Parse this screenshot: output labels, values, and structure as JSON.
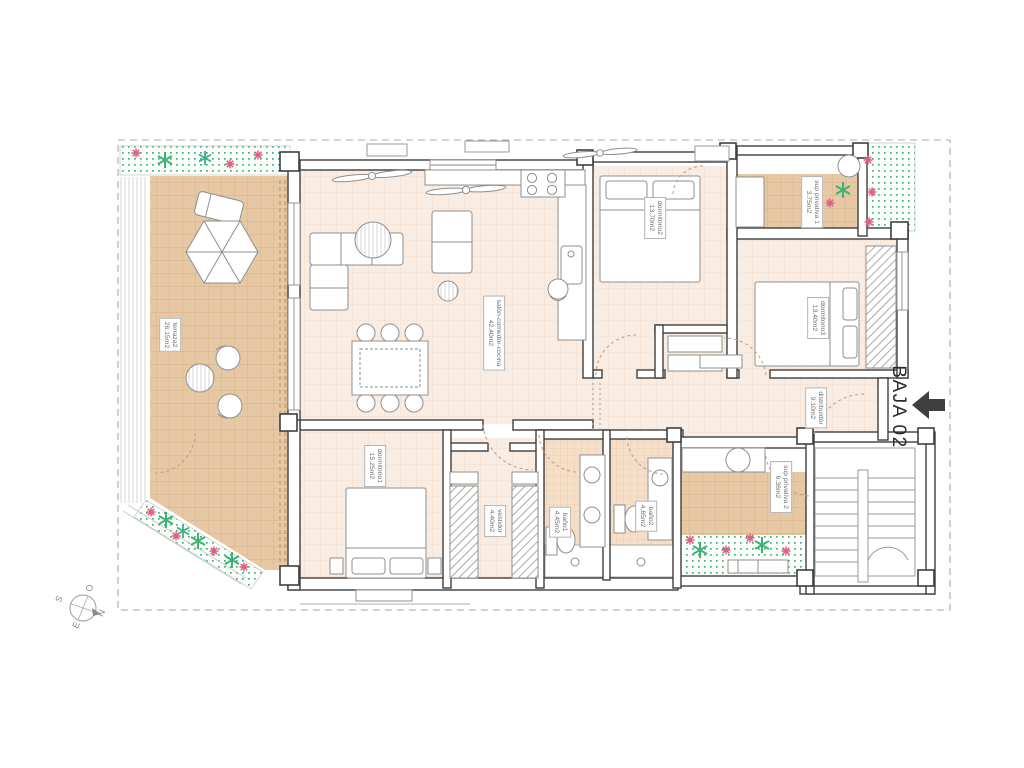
{
  "plan": {
    "title": "BAJA 02",
    "compass": {
      "n": "N",
      "s": "S",
      "e": "E",
      "o": "O"
    },
    "rooms": [
      {
        "name": "terraza2",
        "area": "26.15m2"
      },
      {
        "name": "salón-comedor-cocina",
        "area": "42.40m2"
      },
      {
        "name": "dormitorio2",
        "area": "13.70m2"
      },
      {
        "name": "sup privativa 1",
        "area": "3.75m2"
      },
      {
        "name": "dormitorio3",
        "area": "13.40m2"
      },
      {
        "name": "distribuidor",
        "area": "9.10m2"
      },
      {
        "name": "dormitorio1",
        "area": "15.25m2"
      },
      {
        "name": "vestidor",
        "area": "4.40m2"
      },
      {
        "name": "baño1",
        "area": "4.45m2"
      },
      {
        "name": "baño2",
        "area": "4.65m2"
      },
      {
        "name": "sup privativa 2",
        "area": "6.36m2"
      }
    ],
    "colors": {
      "terrace_tile": "#e6c8a4",
      "interior_floor": "#f9ece3",
      "bath_tile": "#f6dfc9",
      "garden_dot": "#3fae8c",
      "flower_pink": "#e0607f",
      "plant_green": "#3cb371",
      "wall_line": "#3f3f3f",
      "arrow": "#3f3f3f"
    }
  }
}
